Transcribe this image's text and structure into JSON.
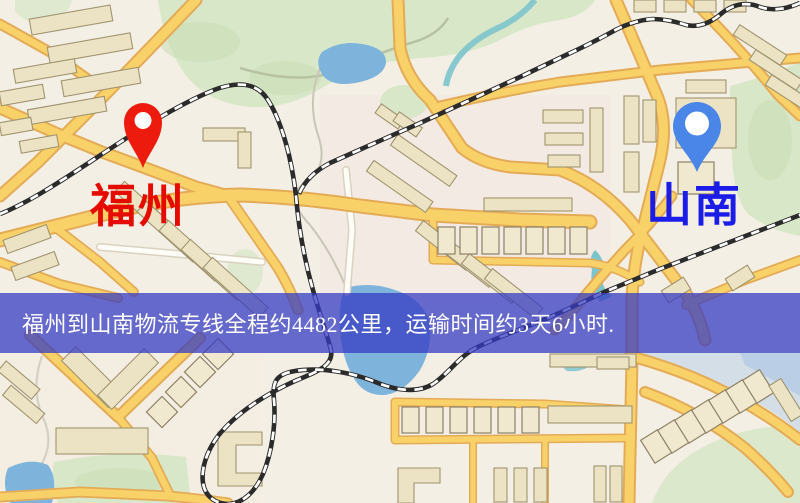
{
  "window": {
    "width": 800,
    "height": 503,
    "kind": "static-route-map-image"
  },
  "map": {
    "type": "road-map",
    "origin_pin": {
      "label": "福州",
      "label_color": "#e60b00",
      "pin_color": "#ec1b0d",
      "pin_x": 143,
      "pin_y": 168
    },
    "destination_pin": {
      "label": "山南",
      "label_color": "#1b1ce8",
      "pin_color": "#4a86e8",
      "pin_x": 697,
      "pin_y": 172
    }
  },
  "banner": {
    "text": "福州到山南物流专线全程约4482公里，运输时间约3天6小时.",
    "origin": "福州",
    "destination": "山南",
    "route_type": "物流专线",
    "distance_km": 4482,
    "duration": "3天6小时",
    "background_color": "#3c3cc3",
    "text_color": "#ffffff"
  },
  "palette": {
    "map_background": "#f4efe5",
    "road_fill": "#f8d169",
    "road_casing": "#e4ab56",
    "minor_road": "#fdfcf7",
    "park_green": "#d9e7c9",
    "water_blue": "#7eb4dc",
    "building_fill": "#ebe3c3",
    "railway_black": "#2b2b2b"
  }
}
